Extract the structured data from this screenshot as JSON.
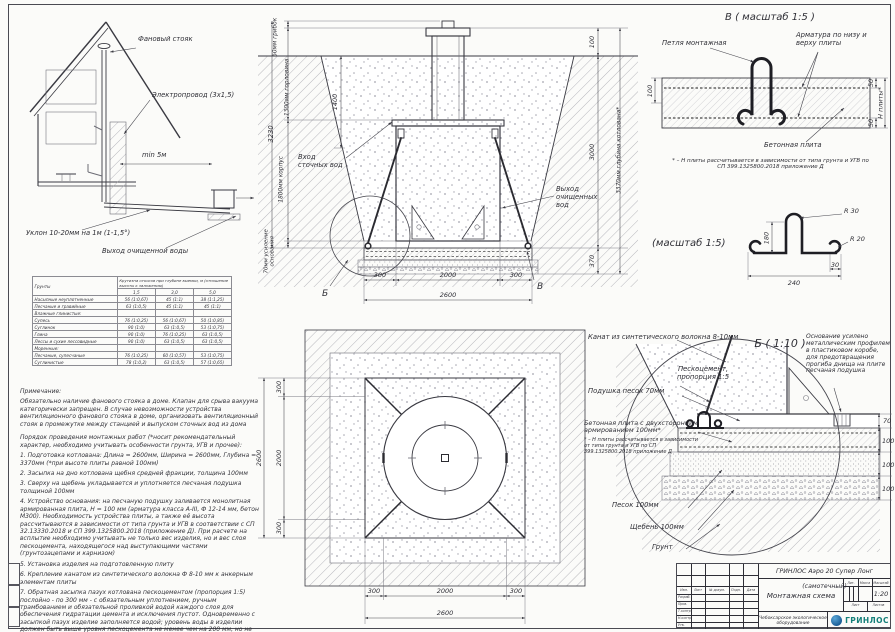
{
  "house": {
    "vent": "Фановый стояк",
    "electric": "Электропровод (3х1,5)",
    "min5": "min 5м",
    "slope": "Уклон 10-20мм на 1м (1-1,5°)",
    "outlet": "Выход очищенной воды"
  },
  "section": {
    "dim_total": "3230",
    "dim_cap": "60мм грибок",
    "dim_neck": "1300мм горловина",
    "dim_body": "1800мм корпус",
    "dim_base": "70мм усиление основания",
    "d1400": "1400",
    "d100": "100",
    "d3000": "3000",
    "d370": "370",
    "dim_depth": "3370мм глубина котлована*",
    "inlet": "Вход сточных вод",
    "outlet": "Выход очищенных вод",
    "d300": "300",
    "d2000": "2000",
    "d2600": "2600",
    "marker_b": "Б",
    "marker_v": "В"
  },
  "plan": {
    "d300": "300",
    "d2000": "2000",
    "d2600": "2600"
  },
  "detail_v": {
    "title": "В ( масштаб 1:5 )",
    "loop": "Петля монтажная",
    "rebar": "Арматура по низу и верху плиты",
    "plate": "Бетонная плита",
    "d100": "100",
    "d50": "50",
    "dH": "Н плиты*",
    "footnote": "* – Н плиты рассчитывается в зависимости от типа грунта и УГВ по СП 399.1325800.2018 приложение Д"
  },
  "detail_bend": {
    "title": "(масштаб 1:5)",
    "r30": "R 30",
    "r20": "R 20",
    "d180": "180",
    "d240": "240",
    "d30": "30"
  },
  "detail_b": {
    "title": "Б ( 1:10 )",
    "rope": "Канат из синтетического волокна 8-10мм",
    "mix": "Пескоцемент, пропорция 1:5",
    "pad": "Подушка песок 70мм",
    "plate": "Бетонная плита с двухсторонним армированием 100мм*",
    "plate_footnote": "* – Н плиты рассчитывается в зависимости от типа грунта и УГВ по СП 399.1325800.2018 приложение Д",
    "sand": "Песок 100мм",
    "gravel": "Щебень 100мм",
    "soil": "Грунт",
    "note": "Основание усилено металлическим профилем в пластиковом коробе, для предотвращения прогиба днища на плите песчаная подушка",
    "d70": "70",
    "d100": "100"
  },
  "soil_table": {
    "col_soil": "Грунты",
    "col_group": "Крутизна откосов при глубине выемки, м (отношение высоты к заложению)",
    "c1": "1,5",
    "c2": "3,0",
    "c3": "5,0",
    "rows": [
      {
        "name": "Насыпные неуплотненные",
        "v": [
          "56 (1:0,67)",
          "45 (1:1)",
          "38 (1:1,25)"
        ]
      },
      {
        "name": "Песчаные и гравийные",
        "v": [
          "63 (1:0,5)",
          "45 (1:1)",
          "45 (1:1)"
        ]
      },
      {
        "name": "Влажные глинистые:",
        "v": [
          "",
          "",
          ""
        ]
      },
      {
        "name": "Супесь",
        "v": [
          "76 (1:0,25)",
          "56 (1:0,67)",
          "50 (1:0,85)"
        ]
      },
      {
        "name": "Суглинок",
        "v": [
          "90 (1:0)",
          "63 (1:0,5)",
          "53 (1:0,75)"
        ]
      },
      {
        "name": "Глина",
        "v": [
          "90 (1:0)",
          "76 (1:0,25)",
          "63 (1:0,5)"
        ]
      },
      {
        "name": "Лессы и сухие лессовидные",
        "v": [
          "90 (1:0)",
          "63 (1:0,5)",
          "63 (1:0,5)"
        ]
      },
      {
        "name": "Моренные:",
        "v": [
          "",
          "",
          ""
        ]
      },
      {
        "name": "Песчаные, супесчаные",
        "v": [
          "76 (1:0,25)",
          "60 (1:0,57)",
          "53 (1:0,75)"
        ]
      },
      {
        "name": "Суглинистые",
        "v": [
          "78 (1:0,2)",
          "63 (1:0,5)",
          "57 (1:0,65)"
        ]
      }
    ]
  },
  "notes": {
    "heading": "Примечание:",
    "para1": "Обязательно наличие фанового стояка в доме. Клапан для срыва вакуума категорически запрещен. В случае невозможности устройства вентиляционного фанового стояка в доме, организовать вентиляционный стояк в промежутке между станцией и выпуском сточных вод из дома",
    "order_heading": "Порядок проведения монтажных работ (*носит рекомендательный характер, необходимо учитывать особенности грунта, УГВ и прочее):",
    "i1": "1. Подготовка котлована: Длина = 2600мм, Ширина = 2600мм, Глубина = 3370мм (*при высоте плиты равной 100мм)",
    "i2": "2. Засыпка на дно котлована щебня средней фракции, толщина 100мм",
    "i3": "3. Сверху на щебень укладывается и уплотняется песчаная подушка толщиной 100мм",
    "i4": "4. Устройство основания: на песчаную подушку заливается монолитная армированная плита, Н = 100 мм (арматура класса А-III, Ф 12-14 мм, бетон М300). Необходимость устройства плиты, а также её высота рассчитываются в зависимости от типа грунта и УГВ в соответствии с СП 32.13330.2018 и СП 399.1325800.2018 (приложение Д). При расчете на всплытие необходимо учитывать не только вес изделия, но и вес слоя пескоцемента, находящегося над выступающими частями (грунтозацепами и карнизом)",
    "i5": "5. Установка изделия на подготовленную плиту",
    "i6": "6. Крепление канатом из синтетического волокна Ф 8-10 мм к анкерным элементам плиты",
    "i7": "7. Обратная засыпка пазух котлована пескоцементом (пропорция 1:5) послойно - по 300 мм - с обязательным уплотнением, ручным трамбованием и обязательной проливкой водой каждого слоя для обеспечения гидратации цемента и исключения пустот. Одновременно с засыпкой пазух изделие заполняется водой; уровень воды в изделии должен быть выше уровня пескоцемента не менее чем на 200 мм, но не более чем на 500 мм"
  },
  "titleblock": {
    "doc_title": "ГРИНЛОС Аэро 20 Супер Лонг (самотечный)",
    "doc_subtitle": "Монтажная схема",
    "scale": "1:20",
    "col_izm": "Изм.",
    "col_list": "Лист",
    "col_doc": "№ докум.",
    "col_podp": "Подп.",
    "col_data": "Дата",
    "row_razrab": "Разраб.",
    "row_prov": "Пров.",
    "row_tkontr": "Т.контр.",
    "row_nkontr": "Н.контр.",
    "row_utv": "Утв.",
    "col_lit": "Лит.",
    "col_massa": "Масса",
    "col_masshtab": "Масштаб",
    "lbl_sheet": "Лист",
    "lbl_sheets": "Листов",
    "company": "Чебоксарское экологическое оборудование",
    "logo_text": "ГРИНЛОС"
  }
}
